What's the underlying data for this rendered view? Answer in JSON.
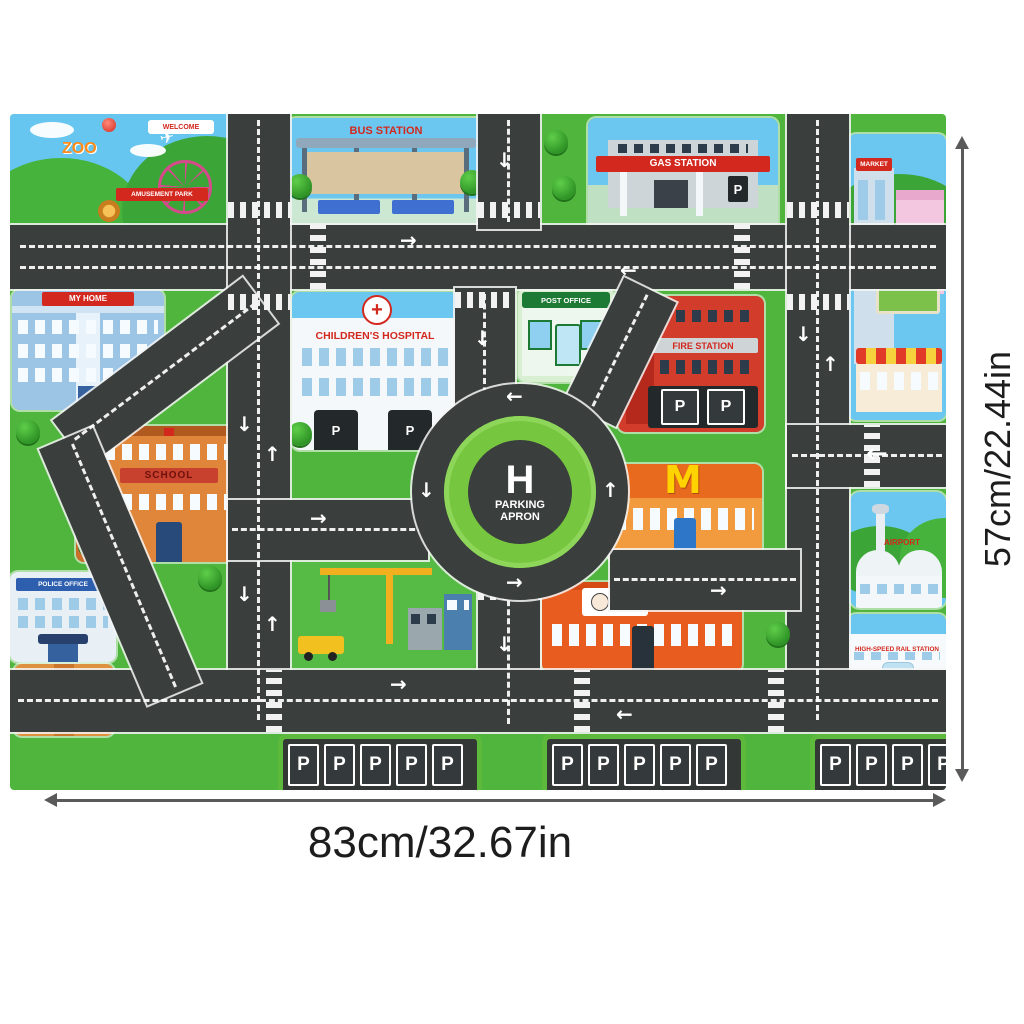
{
  "dimensions": {
    "width_label": "83cm/32.67in",
    "height_label": "57cm/22.44in"
  },
  "mat": {
    "signs": {
      "zoo": "ZOO",
      "welcome": "WELCOME",
      "amusement_park": "AMUSEMENT PARK",
      "bus_station": "BUS STATION",
      "gas_station": "GAS STATION",
      "market": "MARKET",
      "my_home": "MY HOME",
      "childrens_hospital": "CHILDREN'S HOSPITAL",
      "post_office": "POST OFFICE",
      "fire_station": "FIRE STATION",
      "school": "SCHOOL",
      "police_office": "POLICE OFFICE",
      "kfc": "KFC",
      "airport": "AIRPORT",
      "high_speed_rail": "HIGH-SPEED RAIL STATION",
      "heliport_letter": "H",
      "parking_apron": "PARKING APRON",
      "parking_stall": "P"
    },
    "icons": {
      "mcdonalds_arches": "M",
      "hospital_cross": "+",
      "airplane": "✈",
      "arrow_up": "↑",
      "arrow_down": "↓",
      "arrow_left": "←",
      "arrow_right": "→"
    },
    "colors": {
      "grass": "#4fb53c",
      "sky": "#66c6ef",
      "road": "#3a3e3d",
      "sign_red": "#d3281e",
      "parking_green": "#5cb93c"
    }
  }
}
